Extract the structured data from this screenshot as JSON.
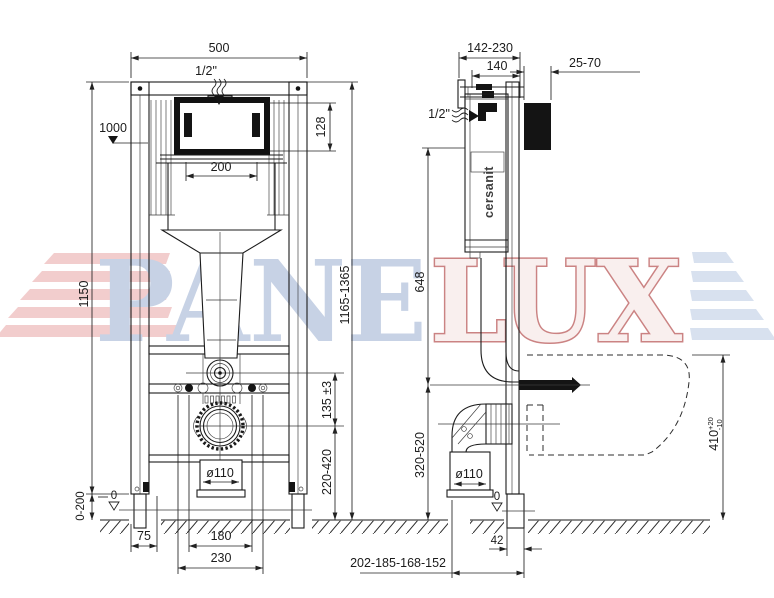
{
  "watermark": {
    "left": "PANE",
    "right": "LUX"
  },
  "front": {
    "width": "500",
    "inlet": "1/2\"",
    "install_height": "1000",
    "opening_width": "200",
    "window_height": "128",
    "frame_height": "1150",
    "total_height": "1165-1365",
    "flush_to_drain": "135 ±3",
    "drain_height": "220-420",
    "drain_diameter": "ø110",
    "leg_adjust": "0-200",
    "floor_zero": "0",
    "foot_offset": "75",
    "bolt_spacing": "180",
    "drain_width": "230"
  },
  "side": {
    "bracket_depth": "142-230",
    "frame_depth": "140",
    "wall_thickness": "25-70",
    "inlet": "1/2\"",
    "brand": "cersanit",
    "inlet_height": "648",
    "drain_axis_height": "320-520",
    "bowl_height": "410",
    "bowl_tol_plus": "+20",
    "bowl_tol_minus": "-10",
    "drain_diameter": "ø110",
    "floor_zero": "0",
    "leg_offset": "42",
    "drain_depths": "202-185-168-152"
  }
}
